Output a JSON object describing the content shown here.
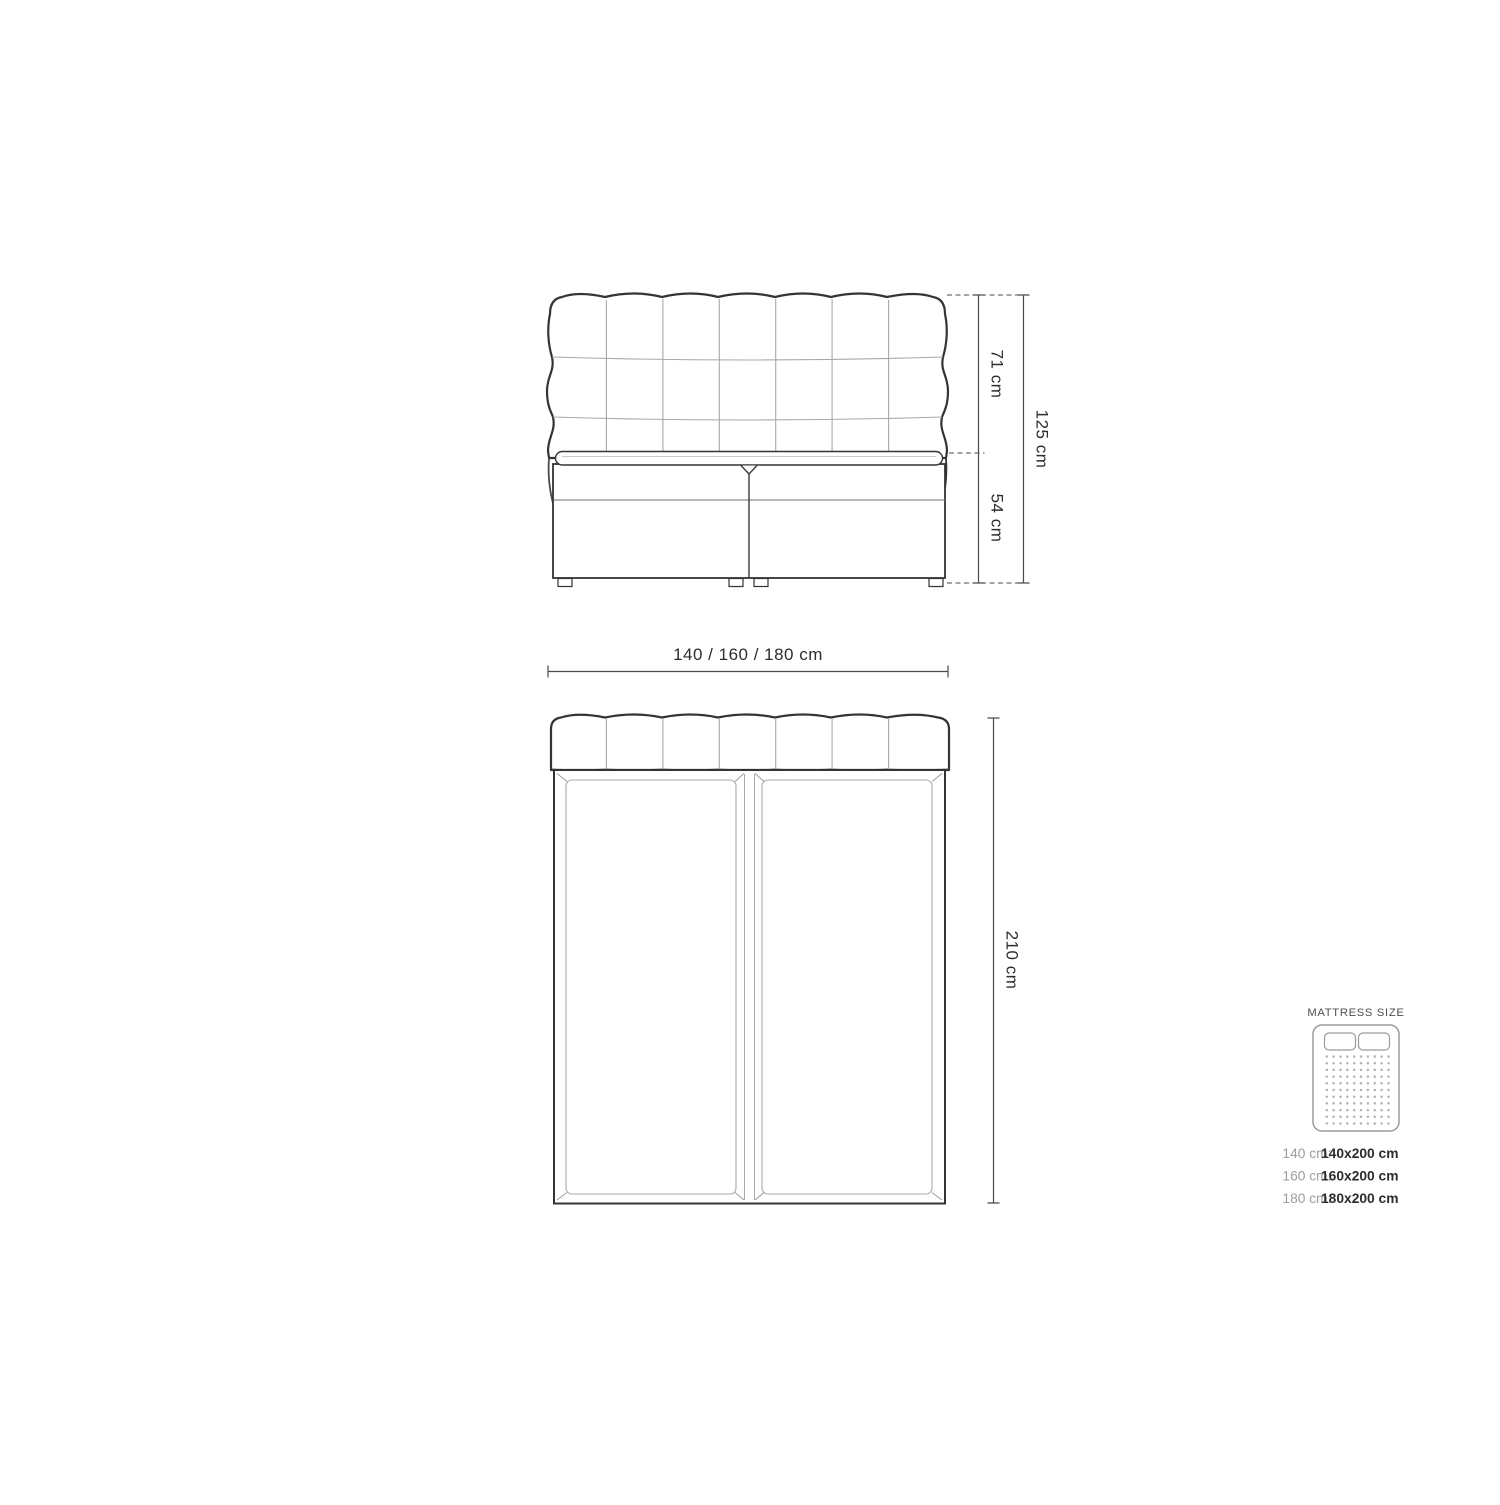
{
  "diagram": {
    "front_view": {
      "headboard_height_label": "71 cm",
      "base_height_label": "54 cm",
      "total_height_label": "125 cm",
      "width_label": "140 / 160 / 180 cm"
    },
    "top_view": {
      "length_label": "210 cm"
    }
  },
  "legend": {
    "title": "MATTRESS SIZE",
    "sizes": [
      {
        "label": "140 cm:",
        "value": "140x200 cm"
      },
      {
        "label": "160 cm:",
        "value": "160x200 cm"
      },
      {
        "label": "180 cm:",
        "value": "180x200 cm"
      }
    ]
  },
  "colors": {
    "outline_dark": "#343434",
    "line_light": "#a8a8a8",
    "dimension_line": "#4a4a4a",
    "text_primary": "#2e2e2e",
    "text_muted": "#9d9d9d",
    "background": "#ffffff"
  }
}
